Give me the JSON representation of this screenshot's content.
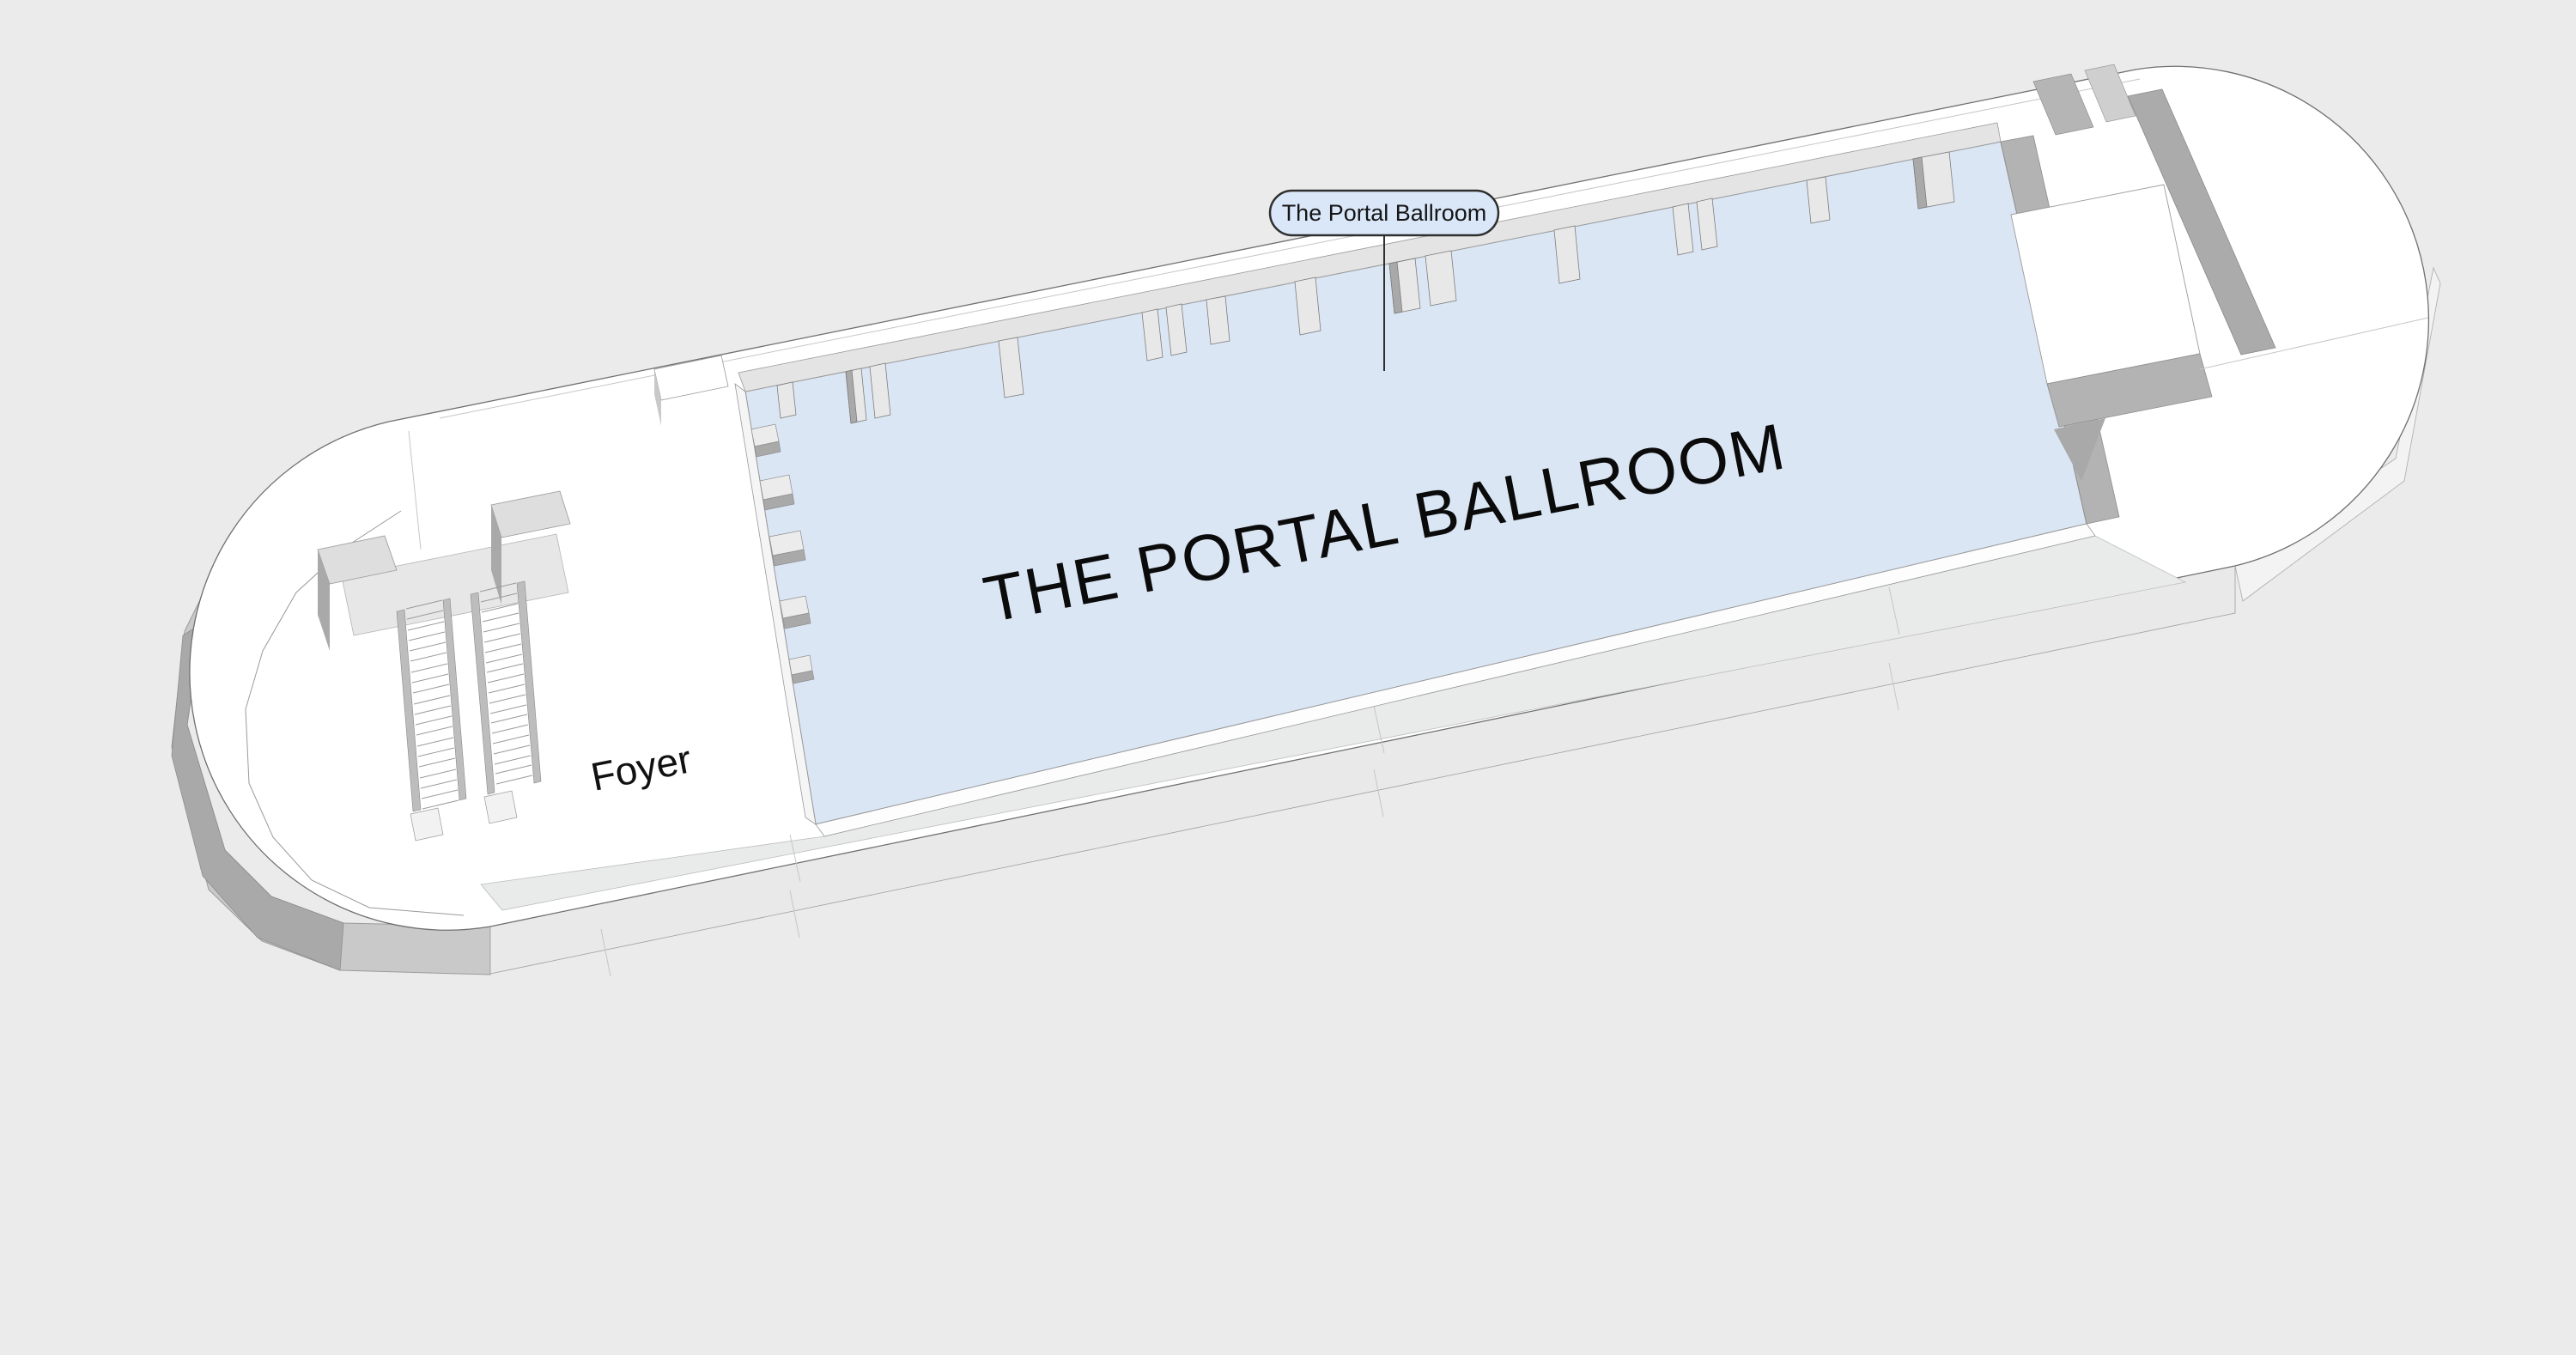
{
  "tooltip": {
    "label": "The Portal Ballroom"
  },
  "labels": {
    "ballroom": "THE PORTAL BALLROOM",
    "foyer": "Foyer"
  },
  "colors": {
    "background": "#ebebeb",
    "floor_white": "#ffffff",
    "ballroom_floor": "#dbe6f5",
    "walkway_gray": "#e9eaea",
    "wall_band": "#e4e4e4",
    "wall_shadow_dark": "#a9a9a9",
    "wall_shadow_mid": "#b9b9b9",
    "exterior_face": "#e9e9e9",
    "tooltip_fill": "#d9e7f8",
    "tooltip_border": "#2f2f2f",
    "outline": "#707070"
  }
}
